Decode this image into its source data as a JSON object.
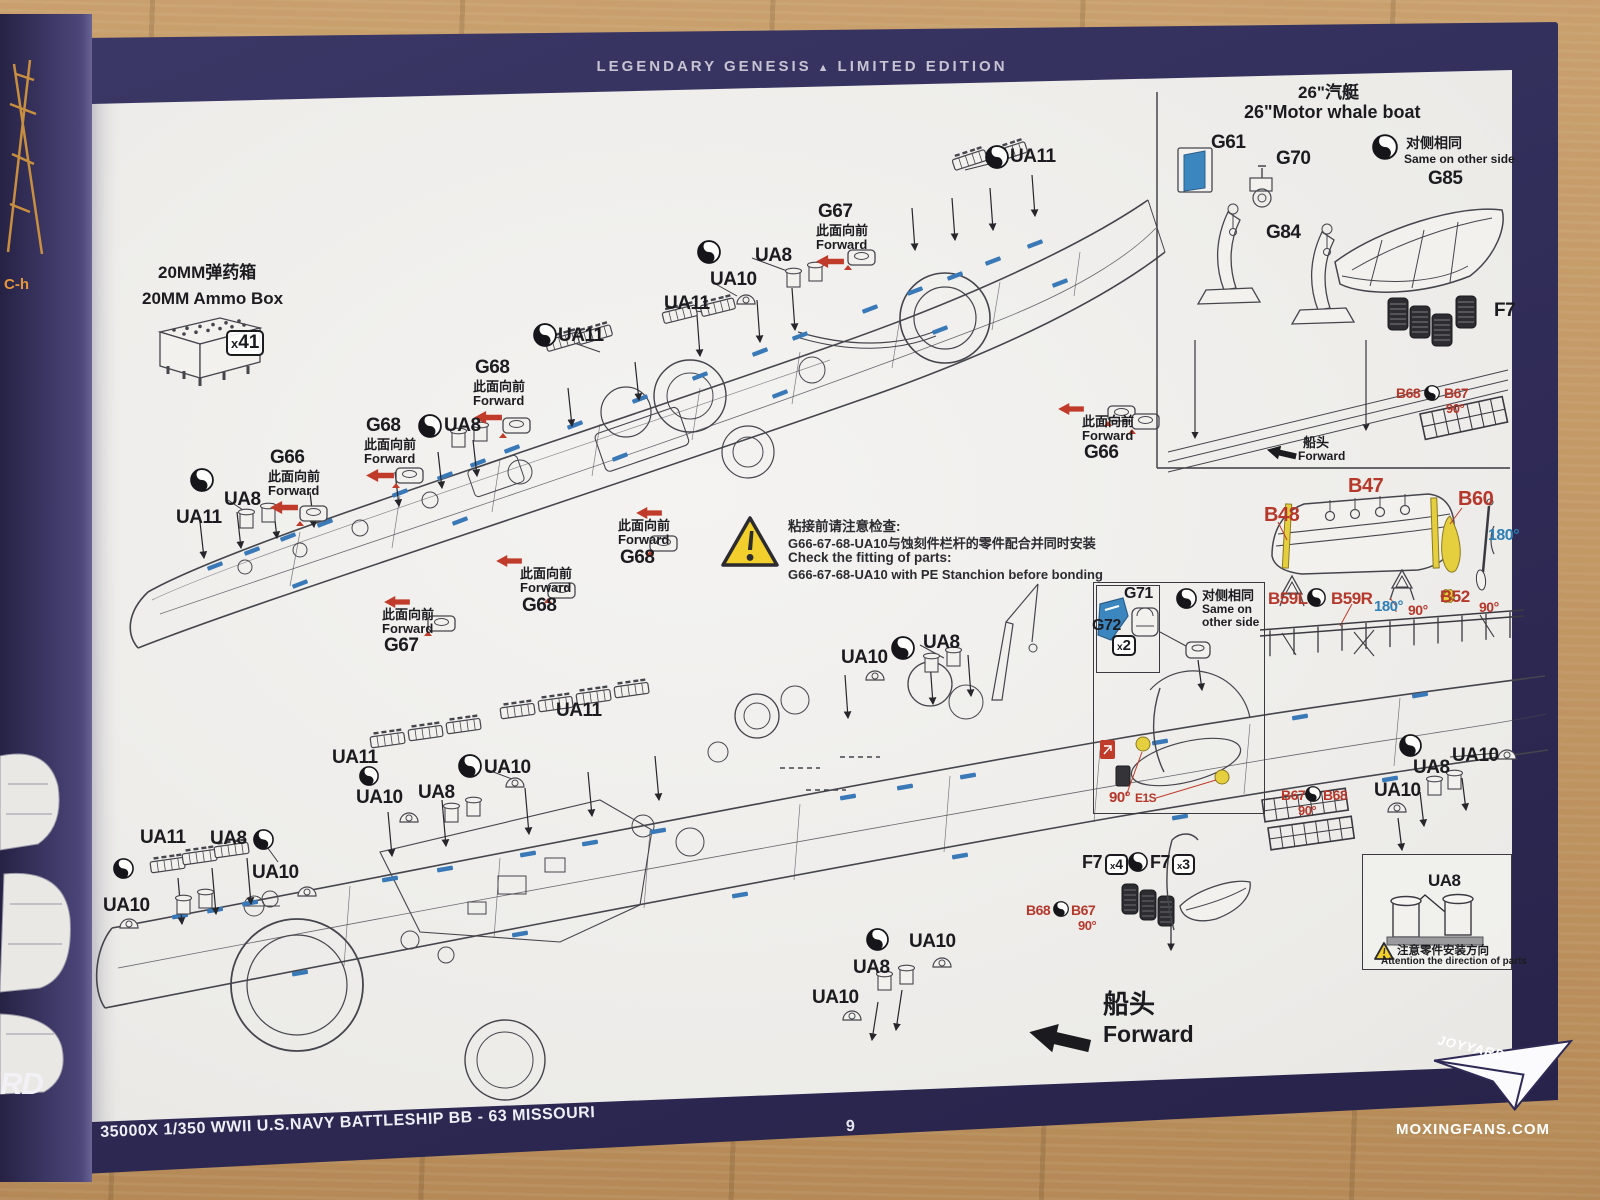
{
  "header": {
    "left": "LEGENDARY GENESIS",
    "tri": "▲",
    "right": "LIMITED EDITION"
  },
  "footer": {
    "kit_title": "35000X 1/350 WWII U.S.NAVY BATTLESHIP BB - 63 MISSOURI",
    "page_number": "9",
    "watermark": "MOXINGFANS.COM",
    "brand": "JOYYARD"
  },
  "legend": {
    "ammo_cn": "20MM弹药箱",
    "ammo_en": "20MM Ammo Box",
    "ammo_qty": "x41"
  },
  "warning": {
    "line1_cn": "粘接前请注意检查:",
    "line2_cn": "G66-67-68-UA10与蚀刻件栏杆的零件配合并同时安装",
    "line3_en": "Check the fitting of parts:",
    "line4_en": "G66-67-68-UA10 with PE Stanchion before bonding"
  },
  "whaleboat": {
    "title_cn": "26\"汽艇",
    "title_en": "26\"Motor whale boat"
  },
  "ua8box": {
    "label": "UA8",
    "note_cn": "注意零件安装方向",
    "note_en": "Attention the direction of parts"
  },
  "forward_big": {
    "cn": "船头",
    "en": "Forward"
  },
  "spine": {
    "fragment1": "C-h",
    "fragment2": "RD"
  },
  "annotations": [
    {
      "t": "c",
      "v": "26\"汽艇",
      "x": 1298,
      "y": 84,
      "s": 17
    },
    {
      "t": "e",
      "v": "26\"Motor whale boat",
      "x": 1244,
      "y": 103,
      "s": 18
    },
    {
      "t": "p",
      "v": "G61",
      "x": 1211,
      "y": 133,
      "s": 19
    },
    {
      "t": "p",
      "v": "G70",
      "x": 1276,
      "y": 149,
      "s": 19
    },
    {
      "t": "y",
      "x": 1372,
      "y": 134,
      "s": 26
    },
    {
      "t": "c",
      "v": "对侧相同",
      "x": 1406,
      "y": 136,
      "s": 14
    },
    {
      "t": "e",
      "v": "Same on other side",
      "x": 1404,
      "y": 153,
      "s": 12
    },
    {
      "t": "p",
      "v": "G85",
      "x": 1428,
      "y": 169,
      "s": 19
    },
    {
      "t": "p",
      "v": "G84",
      "x": 1266,
      "y": 223,
      "s": 19
    },
    {
      "t": "p",
      "v": "F7",
      "x": 1494,
      "y": 301,
      "s": 19
    },
    {
      "t": "r",
      "v": "B68",
      "x": 1396,
      "y": 386,
      "s": 14
    },
    {
      "t": "y",
      "x": 1424,
      "y": 385,
      "s": 16
    },
    {
      "t": "r",
      "v": "B67",
      "x": 1444,
      "y": 386,
      "s": 14
    },
    {
      "t": "r",
      "v": "90°",
      "x": 1446,
      "y": 402,
      "s": 13
    },
    {
      "t": "c",
      "v": "船头",
      "x": 1303,
      "y": 436,
      "s": 13
    },
    {
      "t": "e",
      "v": "Forward",
      "x": 1298,
      "y": 450,
      "s": 12
    },
    {
      "t": "ba",
      "x": 1266,
      "y": 446,
      "s": 30
    },
    {
      "t": "r",
      "v": "B47",
      "x": 1348,
      "y": 476,
      "s": 20
    },
    {
      "t": "r",
      "v": "B48",
      "x": 1264,
      "y": 505,
      "s": 20
    },
    {
      "t": "r",
      "v": "B60",
      "x": 1458,
      "y": 489,
      "s": 20
    },
    {
      "t": "bl",
      "v": "180°",
      "x": 1488,
      "y": 528,
      "s": 16
    },
    {
      "t": "r",
      "v": "B59L",
      "x": 1268,
      "y": 590,
      "s": 17
    },
    {
      "t": "y",
      "x": 1307,
      "y": 588,
      "s": 19
    },
    {
      "t": "r",
      "v": "B59R",
      "x": 1331,
      "y": 590,
      "s": 17
    },
    {
      "t": "bl",
      "v": "180°",
      "x": 1374,
      "y": 599,
      "s": 15
    },
    {
      "t": "r",
      "v": "90°",
      "x": 1408,
      "y": 603,
      "s": 14
    },
    {
      "t": "r",
      "v": "B52",
      "x": 1440,
      "y": 588,
      "s": 17
    },
    {
      "t": "r",
      "v": "90°",
      "x": 1479,
      "y": 600,
      "s": 14
    },
    {
      "t": "y",
      "x": 985,
      "y": 145,
      "s": 24
    },
    {
      "t": "p",
      "v": "UA11",
      "x": 1010,
      "y": 147,
      "s": 19
    },
    {
      "t": "p",
      "v": "G67",
      "x": 818,
      "y": 202,
      "s": 19
    },
    {
      "t": "c",
      "v": "此面向前",
      "x": 816,
      "y": 224,
      "s": 13
    },
    {
      "t": "e",
      "v": "Forward",
      "x": 816,
      "y": 238,
      "s": 13
    },
    {
      "t": "ra",
      "x": 816,
      "y": 255,
      "s": 28
    },
    {
      "t": "y",
      "x": 697,
      "y": 240,
      "s": 24
    },
    {
      "t": "p",
      "v": "UA8",
      "x": 755,
      "y": 246,
      "s": 19
    },
    {
      "t": "p",
      "v": "UA10",
      "x": 710,
      "y": 270,
      "s": 19
    },
    {
      "t": "p",
      "v": "UA11",
      "x": 664,
      "y": 294,
      "s": 19
    },
    {
      "t": "y",
      "x": 533,
      "y": 323,
      "s": 24
    },
    {
      "t": "p",
      "v": "UA11",
      "x": 558,
      "y": 326,
      "s": 19
    },
    {
      "t": "p",
      "v": "G68",
      "x": 475,
      "y": 358,
      "s": 19
    },
    {
      "t": "c",
      "v": "此面向前",
      "x": 473,
      "y": 380,
      "s": 13
    },
    {
      "t": "e",
      "v": "Forward",
      "x": 473,
      "y": 394,
      "s": 13
    },
    {
      "t": "ra",
      "x": 474,
      "y": 411,
      "s": 28
    },
    {
      "t": "y",
      "x": 418,
      "y": 414,
      "s": 24
    },
    {
      "t": "p",
      "v": "UA8",
      "x": 444,
      "y": 416,
      "s": 19
    },
    {
      "t": "p",
      "v": "G68",
      "x": 366,
      "y": 416,
      "s": 19
    },
    {
      "t": "c",
      "v": "此面向前",
      "x": 364,
      "y": 438,
      "s": 13
    },
    {
      "t": "e",
      "v": "Forward",
      "x": 364,
      "y": 452,
      "s": 13
    },
    {
      "t": "ra",
      "x": 366,
      "y": 469,
      "s": 28
    },
    {
      "t": "p",
      "v": "G66",
      "x": 270,
      "y": 448,
      "s": 19
    },
    {
      "t": "c",
      "v": "此面向前",
      "x": 268,
      "y": 470,
      "s": 13
    },
    {
      "t": "e",
      "v": "Forward",
      "x": 268,
      "y": 484,
      "s": 13
    },
    {
      "t": "ra",
      "x": 270,
      "y": 501,
      "s": 28
    },
    {
      "t": "y",
      "x": 190,
      "y": 468,
      "s": 24
    },
    {
      "t": "p",
      "v": "UA8",
      "x": 224,
      "y": 490,
      "s": 19
    },
    {
      "t": "p",
      "v": "UA11",
      "x": 176,
      "y": 508,
      "s": 19
    },
    {
      "t": "ra",
      "x": 636,
      "y": 507,
      "s": 26
    },
    {
      "t": "c",
      "v": "此面向前",
      "x": 618,
      "y": 519,
      "s": 13
    },
    {
      "t": "e",
      "v": "Forward",
      "x": 618,
      "y": 533,
      "s": 13
    },
    {
      "t": "p",
      "v": "G68",
      "x": 620,
      "y": 548,
      "s": 19
    },
    {
      "t": "ra",
      "x": 496,
      "y": 555,
      "s": 26
    },
    {
      "t": "c",
      "v": "此面向前",
      "x": 520,
      "y": 567,
      "s": 13
    },
    {
      "t": "e",
      "v": "Forward",
      "x": 520,
      "y": 581,
      "s": 13
    },
    {
      "t": "p",
      "v": "G68",
      "x": 522,
      "y": 596,
      "s": 19
    },
    {
      "t": "ra",
      "x": 384,
      "y": 596,
      "s": 26
    },
    {
      "t": "c",
      "v": "此面向前",
      "x": 382,
      "y": 608,
      "s": 13
    },
    {
      "t": "e",
      "v": "Forward",
      "x": 382,
      "y": 622,
      "s": 13
    },
    {
      "t": "p",
      "v": "G67",
      "x": 384,
      "y": 636,
      "s": 19
    },
    {
      "t": "ra",
      "x": 1058,
      "y": 403,
      "s": 26
    },
    {
      "t": "c",
      "v": "此面向前",
      "x": 1082,
      "y": 415,
      "s": 13
    },
    {
      "t": "e",
      "v": "Forward",
      "x": 1082,
      "y": 429,
      "s": 13
    },
    {
      "t": "p",
      "v": "G66",
      "x": 1084,
      "y": 443,
      "s": 19
    },
    {
      "t": "p",
      "v": "UA10",
      "x": 841,
      "y": 648,
      "s": 19
    },
    {
      "t": "y",
      "x": 891,
      "y": 636,
      "s": 24
    },
    {
      "t": "p",
      "v": "UA8",
      "x": 923,
      "y": 633,
      "s": 19
    },
    {
      "t": "p",
      "v": "G71",
      "x": 1124,
      "y": 586,
      "s": 16
    },
    {
      "t": "p",
      "v": "G72",
      "x": 1092,
      "y": 618,
      "s": 16
    },
    {
      "t": "bg",
      "v": "x2",
      "x": 1112,
      "y": 635,
      "s": 15
    },
    {
      "t": "y",
      "x": 1176,
      "y": 588,
      "s": 21
    },
    {
      "t": "c",
      "v": "对侧相同",
      "x": 1202,
      "y": 589,
      "s": 13
    },
    {
      "t": "e",
      "v": "Same on",
      "x": 1202,
      "y": 603,
      "s": 12
    },
    {
      "t": "e",
      "v": "other side",
      "x": 1202,
      "y": 616,
      "s": 12
    },
    {
      "t": "r",
      "v": "90°",
      "x": 1109,
      "y": 790,
      "s": 15
    },
    {
      "t": "r",
      "v": "E1S",
      "x": 1135,
      "y": 792,
      "s": 12
    },
    {
      "t": "p",
      "v": "F7",
      "x": 1082,
      "y": 853,
      "s": 18
    },
    {
      "t": "bg",
      "v": "x4",
      "x": 1105,
      "y": 854,
      "s": 14
    },
    {
      "t": "y",
      "x": 1128,
      "y": 852,
      "s": 20
    },
    {
      "t": "p",
      "v": "F7",
      "x": 1150,
      "y": 853,
      "s": 18
    },
    {
      "t": "bg",
      "v": "x3",
      "x": 1172,
      "y": 854,
      "s": 14
    },
    {
      "t": "r",
      "v": "B68",
      "x": 1026,
      "y": 903,
      "s": 14
    },
    {
      "t": "y",
      "x": 1053,
      "y": 901,
      "s": 16
    },
    {
      "t": "r",
      "v": "B67",
      "x": 1071,
      "y": 903,
      "s": 14
    },
    {
      "t": "r",
      "v": "90°",
      "x": 1078,
      "y": 919,
      "s": 13
    },
    {
      "t": "r",
      "v": "B67",
      "x": 1281,
      "y": 788,
      "s": 14
    },
    {
      "t": "y",
      "x": 1305,
      "y": 786,
      "s": 16
    },
    {
      "t": "r",
      "v": "B68",
      "x": 1323,
      "y": 788,
      "s": 14
    },
    {
      "t": "r",
      "v": "90°",
      "x": 1298,
      "y": 804,
      "s": 13
    },
    {
      "t": "y",
      "x": 1399,
      "y": 734,
      "s": 23
    },
    {
      "t": "p",
      "v": "UA10",
      "x": 1452,
      "y": 746,
      "s": 19
    },
    {
      "t": "p",
      "v": "UA8",
      "x": 1413,
      "y": 758,
      "s": 19
    },
    {
      "t": "p",
      "v": "UA10",
      "x": 1374,
      "y": 781,
      "s": 19
    },
    {
      "t": "p",
      "v": "UA11",
      "x": 556,
      "y": 701,
      "s": 19
    },
    {
      "t": "p",
      "v": "UA11",
      "x": 332,
      "y": 748,
      "s": 19
    },
    {
      "t": "y",
      "x": 458,
      "y": 754,
      "s": 24
    },
    {
      "t": "p",
      "v": "UA10",
      "x": 484,
      "y": 758,
      "s": 19
    },
    {
      "t": "p",
      "v": "UA8",
      "x": 418,
      "y": 783,
      "s": 19
    },
    {
      "t": "y",
      "x": 359,
      "y": 766,
      "s": 20
    },
    {
      "t": "p",
      "v": "UA10",
      "x": 356,
      "y": 788,
      "s": 19
    },
    {
      "t": "p",
      "v": "UA11",
      "x": 140,
      "y": 828,
      "s": 19
    },
    {
      "t": "p",
      "v": "UA8",
      "x": 210,
      "y": 829,
      "s": 19
    },
    {
      "t": "y",
      "x": 253,
      "y": 829,
      "s": 21
    },
    {
      "t": "y",
      "x": 113,
      "y": 858,
      "s": 21
    },
    {
      "t": "p",
      "v": "UA10",
      "x": 252,
      "y": 863,
      "s": 19
    },
    {
      "t": "p",
      "v": "UA10",
      "x": 103,
      "y": 896,
      "s": 19
    },
    {
      "t": "y",
      "x": 866,
      "y": 928,
      "s": 23
    },
    {
      "t": "p",
      "v": "UA10",
      "x": 909,
      "y": 932,
      "s": 19
    },
    {
      "t": "p",
      "v": "UA8",
      "x": 853,
      "y": 958,
      "s": 19
    },
    {
      "t": "p",
      "v": "UA10",
      "x": 812,
      "y": 988,
      "s": 19
    },
    {
      "t": "c",
      "v": "船头",
      "x": 1103,
      "y": 991,
      "s": 26
    },
    {
      "t": "e",
      "v": "Forward",
      "x": 1103,
      "y": 1022,
      "s": 23
    },
    {
      "t": "ba",
      "x": 1028,
      "y": 1024,
      "s": 62
    },
    {
      "t": "bg",
      "v": "x41",
      "x": 226,
      "y": 330,
      "s": 19
    },
    {
      "t": "p",
      "v": "UA8",
      "x": 1428,
      "y": 872,
      "s": 17
    }
  ]
}
